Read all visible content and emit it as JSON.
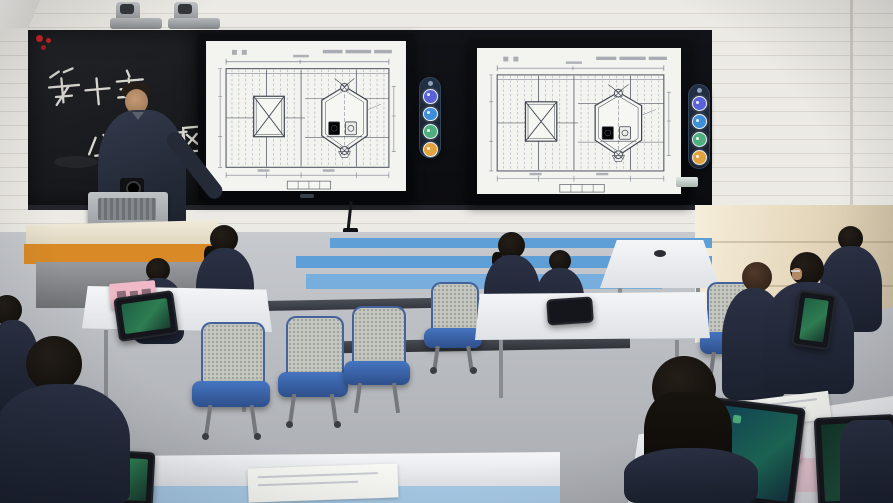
{
  "blackboard": {
    "chalk_line1": "第十章",
    "chalk_line2": "分段",
    "chalk_line3": "构图"
  },
  "toolbar": {
    "buttons": [
      {
        "name": "annotation-tool-1",
        "color": "#5a62d8"
      },
      {
        "name": "annotation-tool-2",
        "color": "#3e8ed8"
      },
      {
        "name": "annotation-tool-3",
        "color": "#4fae7e"
      },
      {
        "name": "annotation-tool-4",
        "color": "#e2a23e"
      }
    ]
  },
  "colors": {
    "wall_brick": "#e9e6e0",
    "display_panel": "#101116",
    "blackboard": "#1d1e23",
    "slide_background": "#f3f3ef",
    "drawing_line": "#5b6170",
    "wall_stripe_blue": "#5f9fd8",
    "floor_gray": "#b6b9bd",
    "warm_wall": "#ead9bd",
    "chair_blue": "#3d6cb4",
    "uniform_navy": "#232837",
    "lectern_orange": "#d98a26",
    "desk_white": "#eef0f2",
    "desk_edge_blue": "#a8cae6",
    "pink_card": "#f0b9c8",
    "tablet_screen": "#2e7d52"
  }
}
